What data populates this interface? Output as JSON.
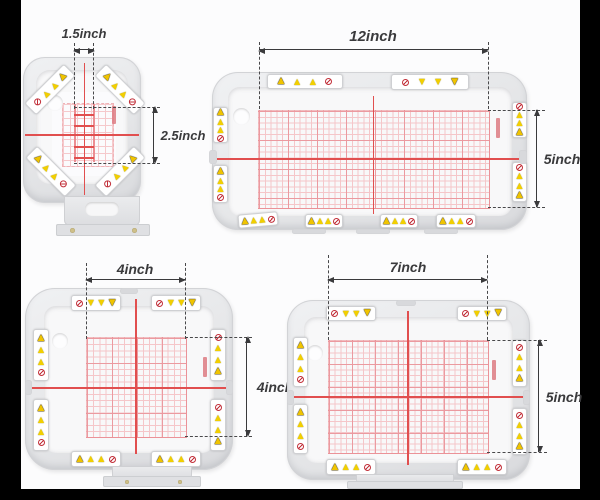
{
  "scene": {
    "description": "Magnetic embroidery hoop set shown in four sizes with inch dimension callouts",
    "letterbox_color": "#000000",
    "photo_background": "#fcfcfd"
  },
  "colors": {
    "frame_gray": "#e6e7e9",
    "inner_white": "#f8f8f9",
    "grid_pink": "#f5c6c9",
    "grid_red": "#eb9aa0",
    "crosshair_red": "#e14f4f",
    "dimension_text": "#3a3a3c",
    "warning_yellow": "#f2cf00",
    "prohibition_red": "#c2303a"
  },
  "hoops": [
    {
      "name": "magnetic-hoop-small",
      "width_label": "1.5inch",
      "height_label": "2.5inch"
    },
    {
      "name": "magnetic-hoop-large",
      "width_label": "12inch",
      "height_label": "5inch"
    },
    {
      "name": "magnetic-hoop-square",
      "width_label": "4inch",
      "height_label": "4inch"
    },
    {
      "name": "magnetic-hoop-medium",
      "width_label": "7inch",
      "height_label": "5inch"
    }
  ]
}
